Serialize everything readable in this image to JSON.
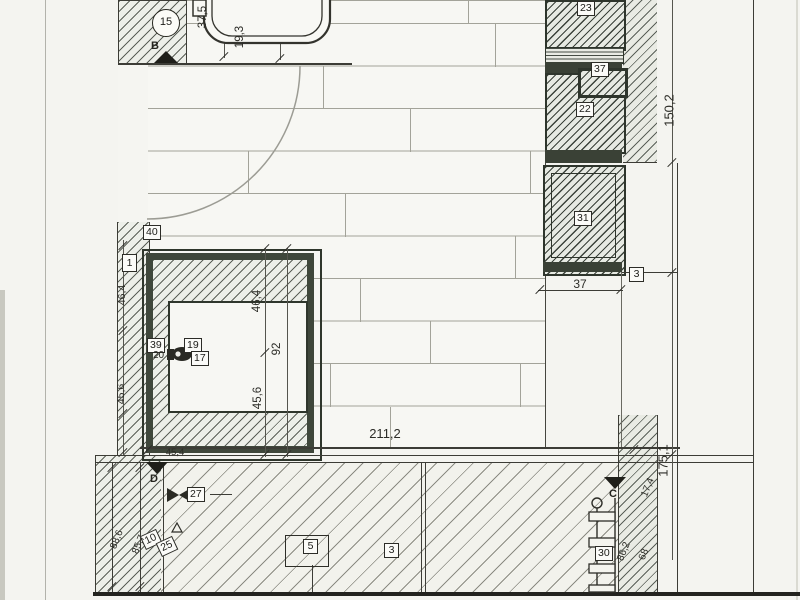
{
  "drawing": {
    "kind": "scanned bathroom floor plan detail",
    "section_markers": {
      "b": "B",
      "d": "D",
      "c": "C"
    },
    "callouts": {
      "c15": "15",
      "c40": "40",
      "c1": "1",
      "c39": "39",
      "c20": "20",
      "c19": "19",
      "c17": "17",
      "c23": "23",
      "c37": "37",
      "c22": "22",
      "c31": "31",
      "c3_shaft": "3",
      "c27": "27",
      "c10": "10",
      "c25": "25",
      "c5": "5",
      "c3_floor": "3",
      "c30": "30"
    },
    "dimensions": {
      "d37_5": "37,5",
      "d19_3": "19,3",
      "d150_2": "150,2",
      "d46_4_wall": "46,4",
      "d45_6_wall": "45,6",
      "d46_4": "46,4",
      "d92": "92",
      "d45_6": "45,6",
      "d211_2": "211,2",
      "d45_4": "45,4",
      "d37": "37",
      "d175_1": "175,1",
      "d17_4": "17,4",
      "d88_6": "88,6",
      "d85_7": "85,7",
      "d86_2": "86,2",
      "d68": "68"
    }
  }
}
